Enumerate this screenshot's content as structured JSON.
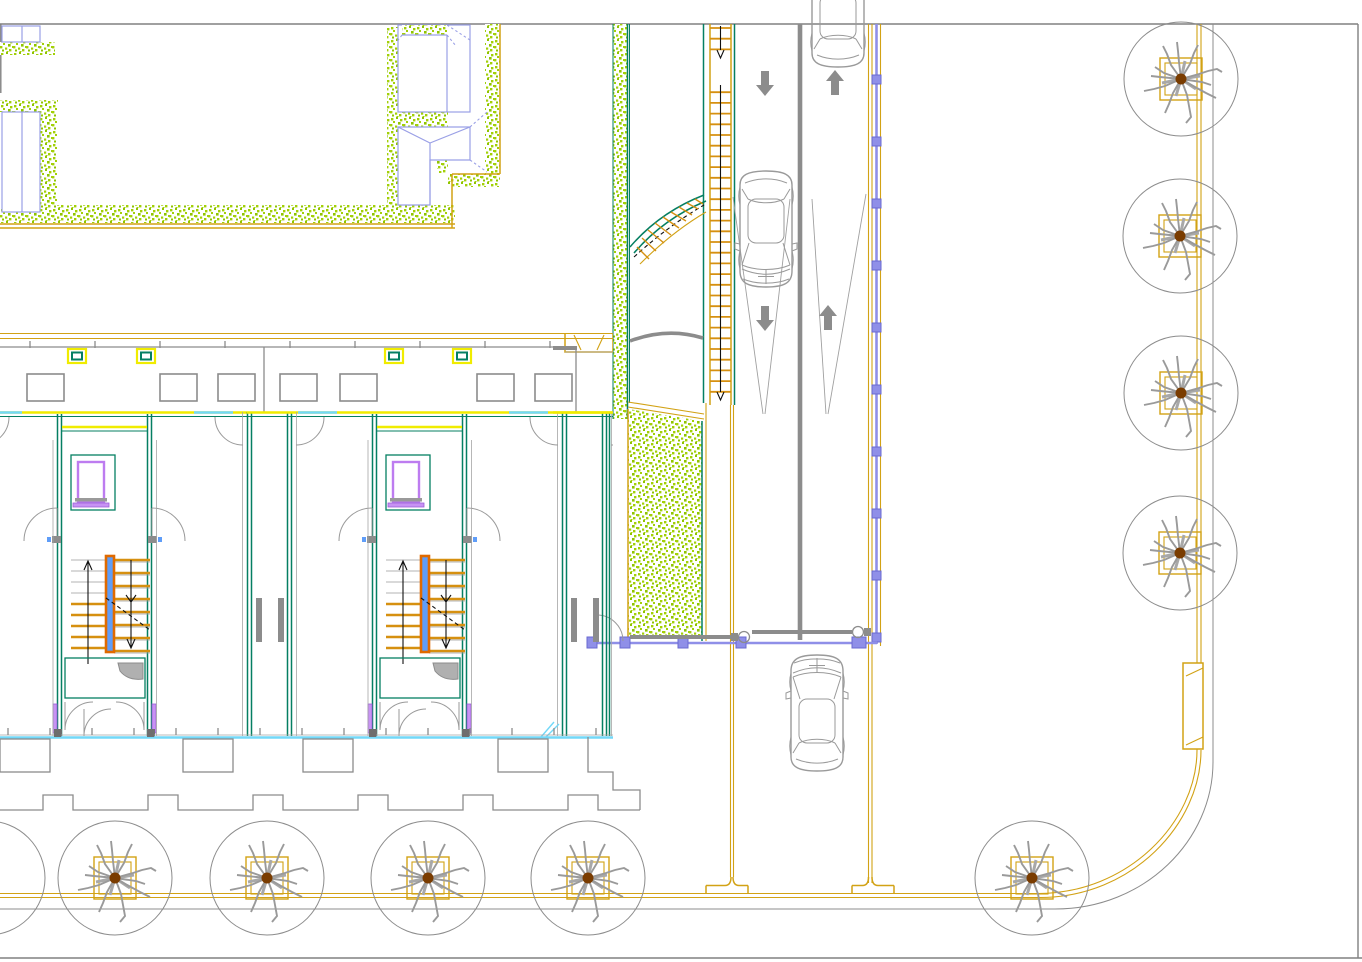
{
  "scene": {
    "kind": "cad-site-plan-drawing",
    "background": "#ffffff",
    "width_px": 1362,
    "height_px": 962
  },
  "palette": {
    "outline_gray": "#8c8c8c",
    "light_gray": "#9a9a9a",
    "curb_gold": "#d2a215",
    "accent_yellow": "#f0ec00",
    "wall_teal": "#057f62",
    "landscape_green": "#a2d007",
    "landscape_green_dark": "#8fc400",
    "roof_blue": "#9aa0e6",
    "fence_blue": "#8f8fe8",
    "stair_rail_blue": "#5f9df8",
    "stair_rail_orange": "#e06a00",
    "fixture_purple": "#bd7cf0",
    "sill_cyan": "#72d8f8",
    "tree_trunk_brown": "#7a3c00",
    "tread_gold": "#d69010"
  },
  "road": {
    "lane_divider": {
      "x": 800,
      "y_top": 24,
      "y_bottom": 640
    },
    "direction_arrows": [
      {
        "x": 765,
        "tip_y": 96,
        "dir": "down"
      },
      {
        "x": 765,
        "tip_y": 331,
        "dir": "down"
      },
      {
        "x": 835,
        "tip_y": 70,
        "dir": "up"
      },
      {
        "x": 828,
        "tip_y": 305,
        "dir": "up"
      }
    ],
    "taper_lines": [
      [
        733,
        197,
        763,
        414
      ],
      [
        790,
        199,
        765,
        414
      ],
      [
        812,
        199,
        826,
        414
      ],
      [
        866,
        194,
        828,
        414
      ]
    ]
  },
  "cars": [
    {
      "x": 838,
      "y": 9,
      "heading": "up"
    },
    {
      "x": 766,
      "y": 229,
      "heading": "down"
    },
    {
      "x": 817,
      "y": 713,
      "heading": "up"
    }
  ],
  "fence_posts_y": [
    75,
    137,
    199,
    261,
    323,
    385,
    447,
    509,
    571,
    633
  ],
  "gate": {
    "bar_y": 643,
    "x_start": 590,
    "x_end": 877,
    "posts_x": [
      592,
      625,
      683,
      741,
      857
    ],
    "arms": [
      {
        "x1": 630,
        "x2": 738,
        "y": 637,
        "hinge_x": 744
      },
      {
        "x1": 752,
        "x2": 852,
        "y": 632,
        "hinge_x": 858
      }
    ]
  },
  "pedestrian_ramp": {
    "rail_x1": 710,
    "rail_x2": 731,
    "y_top": 28,
    "y_bottom": 400,
    "tread_step": 10.7,
    "arrow_gap": [
      56,
      84
    ]
  },
  "curved_stair_rungs": [
    [
      637,
      247,
      649,
      259
    ],
    [
      642,
      238,
      656,
      251
    ],
    [
      648,
      230,
      664,
      243
    ],
    [
      655,
      223,
      671,
      235
    ],
    [
      663,
      217,
      679,
      228
    ],
    [
      671,
      212,
      686,
      221
    ],
    [
      679,
      207,
      692,
      215
    ],
    [
      687,
      203,
      698,
      209
    ],
    [
      695,
      199,
      703,
      204
    ]
  ],
  "stairs": {
    "left_run": {
      "x1": 139,
      "x2": 174,
      "y0": 560,
      "y1": 648,
      "step": 11,
      "gold_from": 604
    },
    "right_run": {
      "x1": 182,
      "x2": 218,
      "y0": 560,
      "y1": 651,
      "step": 13
    }
  },
  "trees": {
    "canopy_radius": 57,
    "planter_half": 21,
    "right_column": [
      {
        "x": 1181,
        "y": 79
      },
      {
        "x": 1180,
        "y": 236
      },
      {
        "x": 1181,
        "y": 393
      },
      {
        "x": 1180,
        "y": 553
      }
    ],
    "bottom_row": [
      {
        "x": 115,
        "y": 878
      },
      {
        "x": 267,
        "y": 878
      },
      {
        "x": 428,
        "y": 878
      },
      {
        "x": 588,
        "y": 878
      },
      {
        "x": 1032,
        "y": 878
      }
    ],
    "edge_partial": {
      "x": -12,
      "y": 878
    }
  },
  "townhouse": {
    "module_origins_x": [
      -68,
      247,
      562
    ],
    "module_width": 315,
    "roof_windows_x": [
      68,
      137,
      385,
      453
    ],
    "skylights_x": [
      27,
      160,
      218,
      280,
      340,
      477,
      535
    ],
    "eave_ticks_x": [
      30,
      95,
      160,
      225,
      290,
      355,
      420,
      485,
      550
    ],
    "sill_tick_start": 8,
    "sill_tick_step": 42,
    "sill_tick_end": 600,
    "jamb_marks_x": [
      54,
      147,
      369,
      462
    ],
    "balconies_x": [
      0,
      183,
      303,
      498
    ],
    "parapet_tabs_x": [
      43,
      148,
      253,
      358,
      463,
      568
    ]
  }
}
